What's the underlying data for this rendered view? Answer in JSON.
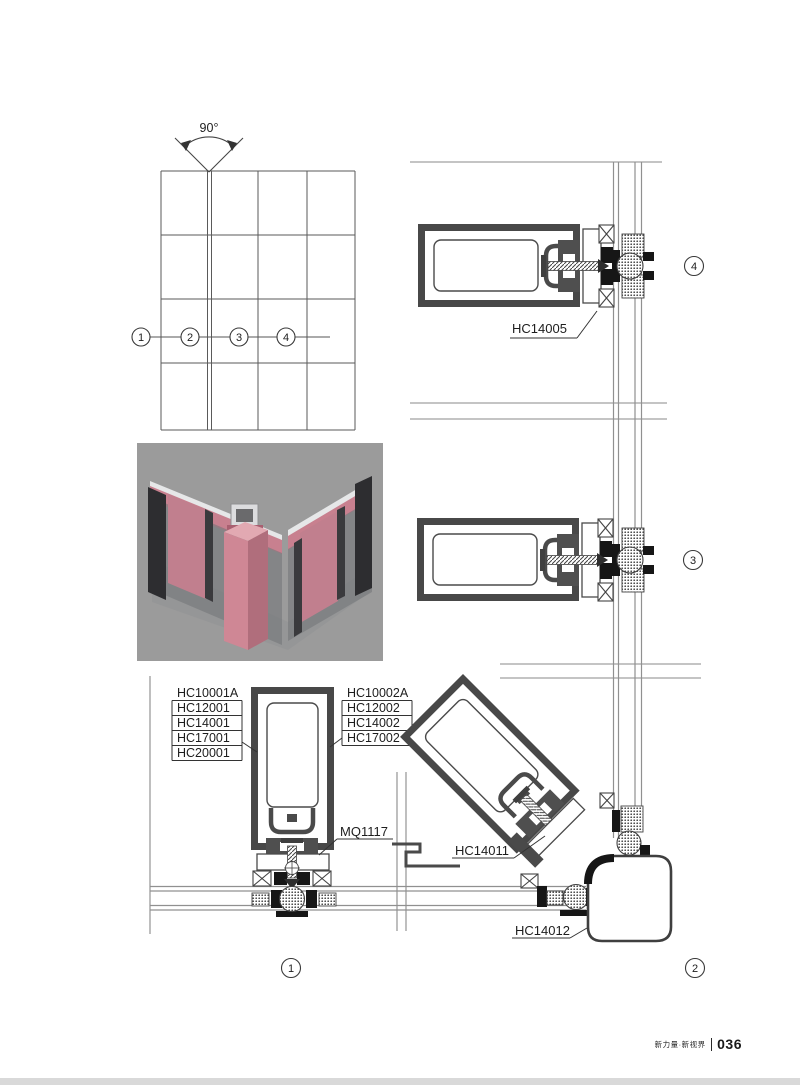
{
  "elevation": {
    "angle": "90°",
    "callouts": [
      "1",
      "2",
      "3",
      "4"
    ]
  },
  "details": {
    "d4": {
      "number": "4",
      "part": "HC14005"
    },
    "d3": {
      "number": "3"
    },
    "d1": {
      "number": "1",
      "left_parts": [
        "HC10001A",
        "HC12001",
        "HC14001",
        "HC17001",
        "HC20001"
      ],
      "right_parts": [
        "HC10002A",
        "HC12002",
        "HC14002",
        "HC17002"
      ],
      "connector_part": "MQ1117"
    },
    "d2": {
      "number": "2",
      "parts": {
        "connector": "HC14011",
        "corner_tube": "HC14012"
      }
    }
  },
  "render3d": {
    "colors": {
      "background": "#9b9b9b",
      "profile_pink": "#cf8795",
      "glass": "#7a7c7f",
      "mullion_dark": "#2d2d30"
    }
  },
  "footer": {
    "brand": "新力量·新视界",
    "page_number": "036"
  }
}
